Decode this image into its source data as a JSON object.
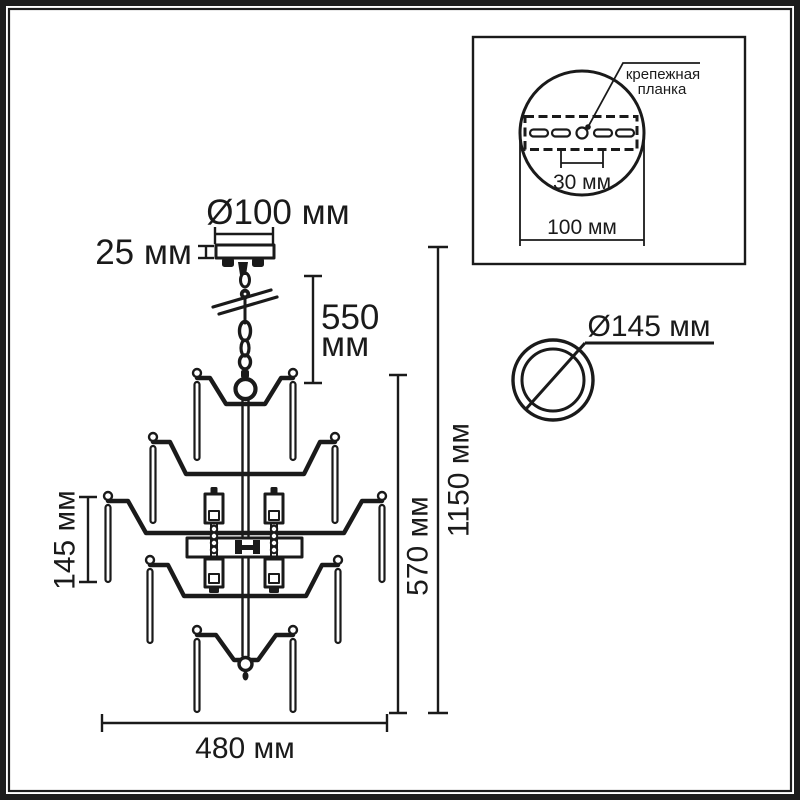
{
  "front_view_dims": {
    "canopy_diameter": "Ø100 мм",
    "canopy_height": "25 мм",
    "chain_length_value": "550",
    "chain_length_unit": "мм",
    "body_height": "570 мм",
    "total_height": "1150 мм",
    "tier_pendant_length": "145 мм",
    "fixture_width": "480 мм"
  },
  "mount_inset": {
    "plate_label_line1": "крепежная",
    "plate_label_line2": "планка",
    "slot_spacing": "30 мм",
    "plate_width": "100 мм"
  },
  "ring_view": {
    "diameter": "Ø145 мм"
  },
  "colors": {
    "line": "#1a1a1a",
    "frame": "#1c1c1c",
    "background": "#ffffff"
  }
}
